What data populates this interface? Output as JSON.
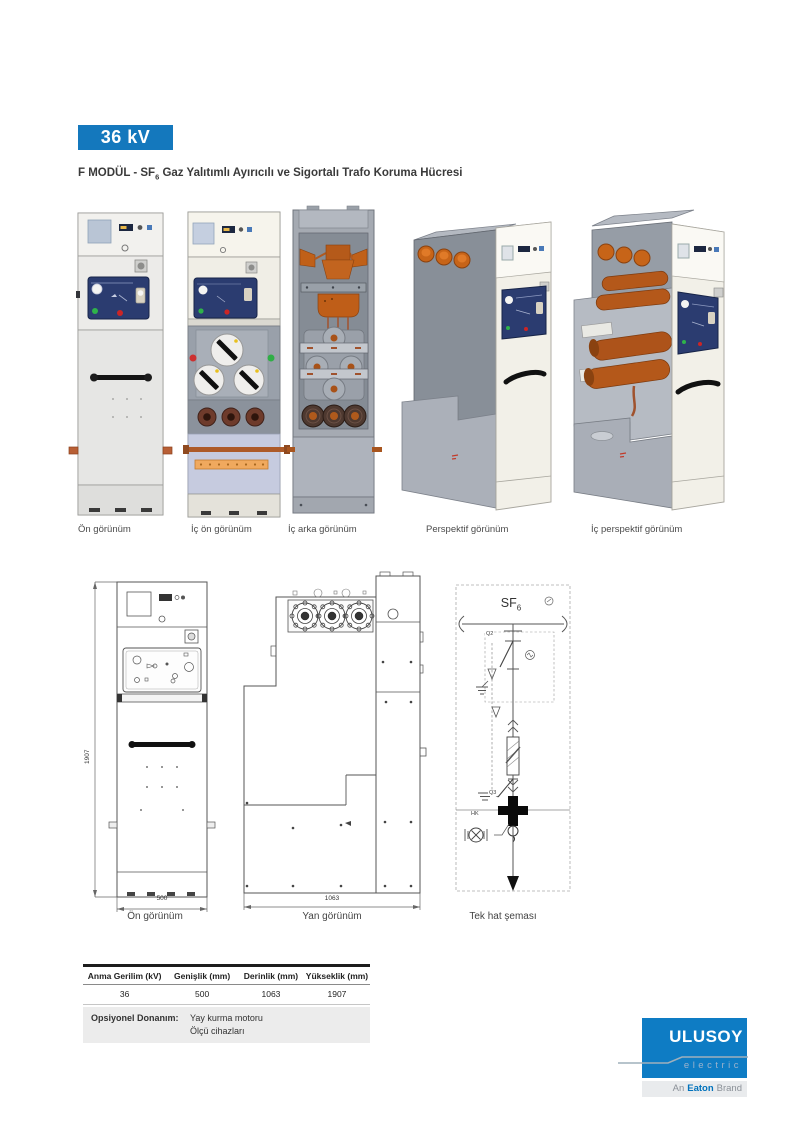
{
  "header": {
    "voltage_badge": "36 kV",
    "title_prefix": "F MODÜL - SF",
    "title_subscript": "6",
    "title_suffix": " Gaz Yalıtımlı Ayırıcılı ve Sigortalı Trafo Koruma Hücresi"
  },
  "product_views": {
    "captions": [
      {
        "label": "Ön görünüm"
      },
      {
        "label": "İç ön görünüm"
      },
      {
        "label": "İç arka görünüm"
      },
      {
        "label": "Perspektif görünüm"
      },
      {
        "label": "İç perspektif görünüm"
      }
    ]
  },
  "drawings": {
    "front": {
      "caption": "Ön görünüm",
      "width_dim": "500",
      "height_dim": "1907"
    },
    "side": {
      "caption": "Yan görünüm",
      "depth_dim": "1063"
    },
    "single_line": {
      "caption": "Tek hat şeması",
      "gas_prefix": "SF",
      "gas_subscript": "6",
      "switch_label": "Q2",
      "earth_switch_label": "Q3",
      "hk_label": "HK"
    }
  },
  "spec_table": {
    "headers": [
      "Anma Gerilim (kV)",
      "Genişlik (mm)",
      "Derinlik (mm)",
      "Yükseklik (mm)"
    ],
    "values": [
      "36",
      "500",
      "1063",
      "1907"
    ],
    "optional_label": "Opsiyonel Donanım:",
    "optional_items": [
      "Yay kurma motoru",
      "Ölçü cihazları"
    ]
  },
  "logo": {
    "brand": "ULUSOY",
    "sub_brand": "electric",
    "tagline_prefix": "An",
    "tagline_brand": "Eaton",
    "tagline_suffix": "Brand"
  },
  "colors": {
    "accent_blue": "#1478bd",
    "logo_blue": "#0e7cc4",
    "eaton_blue": "#0072bc",
    "panel_navy": "#2b3c70",
    "copper": "#b4581a",
    "optional_bg": "#ececec"
  }
}
